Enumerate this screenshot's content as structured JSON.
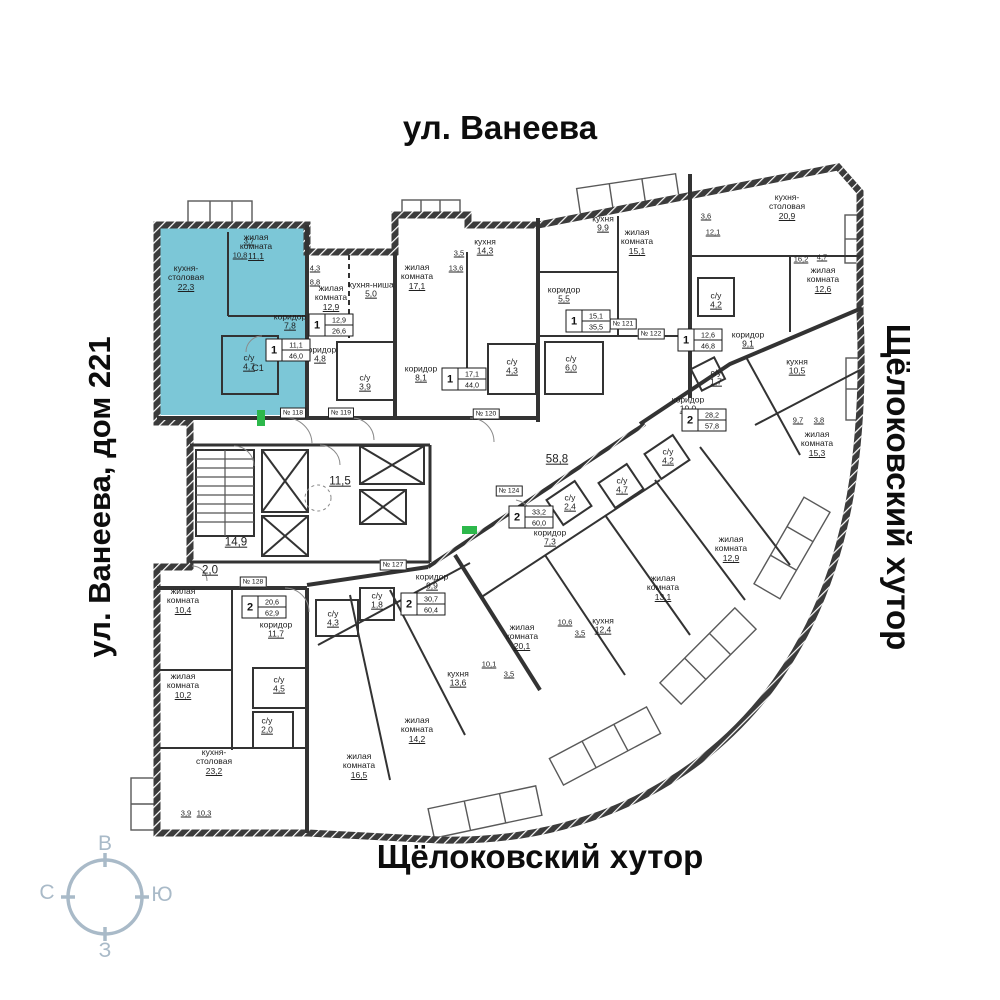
{
  "streets": {
    "top": "ул. Ванеева",
    "left": "ул. Ванеева, дом 221",
    "right": "Щёлоковский хутор",
    "bottom": "Щёлоковский хутор"
  },
  "compass": {
    "top": "В",
    "right": "Ю",
    "bottom": "З",
    "left": "С"
  },
  "colors": {
    "highlight": "#7cc7d7",
    "compass": "#a9bac8",
    "exit_green": "#2db84b",
    "wall": "#333333"
  },
  "selected_apartment": {
    "unit_id": "С1",
    "rooms": "1",
    "living_area": "11,1",
    "total_area": "46,0"
  },
  "unit_label": {
    "text": "С1",
    "x": 258,
    "y": 368
  },
  "apartment_badges": [
    {
      "rooms": "1",
      "living_area": "11,1",
      "total_area": "46,0",
      "x": 288,
      "y": 350,
      "selected": true
    },
    {
      "rooms": "1",
      "living_area": "12,9",
      "total_area": "26,6",
      "x": 331,
      "y": 325
    },
    {
      "rooms": "1",
      "living_area": "17,1",
      "total_area": "44,0",
      "x": 464,
      "y": 379
    },
    {
      "rooms": "1",
      "living_area": "15,1",
      "total_area": "35,5",
      "x": 588,
      "y": 321
    },
    {
      "rooms": "1",
      "living_area": "12,6",
      "total_area": "46,8",
      "x": 700,
      "y": 340
    },
    {
      "rooms": "2",
      "living_area": "28,2",
      "total_area": "57,8",
      "x": 704,
      "y": 420
    },
    {
      "rooms": "2",
      "living_area": "33,2",
      "total_area": "60,0",
      "x": 531,
      "y": 517
    },
    {
      "rooms": "2",
      "living_area": "30,7",
      "total_area": "60,4",
      "x": 423,
      "y": 604
    },
    {
      "rooms": "2",
      "living_area": "20,6",
      "total_area": "62,9",
      "x": 264,
      "y": 607
    }
  ],
  "room_labels": [
    {
      "name": "кухня-\nстоловая",
      "area": "22,3",
      "x": 186,
      "y": 278
    },
    {
      "name": "жилая\nкомната",
      "area": "11,1",
      "x": 256,
      "y": 247
    },
    {
      "name": "коридор",
      "area": "7,8",
      "x": 290,
      "y": 322
    },
    {
      "name": "с/у",
      "area": "4,7",
      "x": 249,
      "y": 363
    },
    {
      "name": "жилая\nкомната",
      "area": "12,9",
      "x": 331,
      "y": 298
    },
    {
      "name": "кухня-ниша",
      "area": "5,0",
      "x": 371,
      "y": 290
    },
    {
      "name": "коридор",
      "area": "4,8",
      "x": 320,
      "y": 355
    },
    {
      "name": "с/у",
      "area": "3,9",
      "x": 365,
      "y": 383
    },
    {
      "name": "жилая\nкомната",
      "area": "17,1",
      "x": 417,
      "y": 277
    },
    {
      "name": "кухня",
      "area": "14,3",
      "x": 485,
      "y": 247
    },
    {
      "name": "коридор",
      "area": "8,1",
      "x": 421,
      "y": 374
    },
    {
      "name": "с/у",
      "area": "4,3",
      "x": 512,
      "y": 367
    },
    {
      "name": "кухня",
      "area": "9,9",
      "x": 603,
      "y": 224
    },
    {
      "name": "жилая\nкомната",
      "area": "15,1",
      "x": 637,
      "y": 242
    },
    {
      "name": "коридор",
      "area": "5,5",
      "x": 564,
      "y": 295
    },
    {
      "name": "с/у",
      "area": "6,0",
      "x": 571,
      "y": 364
    },
    {
      "name": "кухня-\nстоловая",
      "area": "20,9",
      "x": 787,
      "y": 207
    },
    {
      "name": "жилая\nкомната",
      "area": "12,6",
      "x": 823,
      "y": 280
    },
    {
      "name": "с/у",
      "area": "4,2",
      "x": 716,
      "y": 301
    },
    {
      "name": "коридор",
      "area": "9,1",
      "x": 748,
      "y": 340
    },
    {
      "name": "коридор",
      "area": "10,0",
      "x": 688,
      "y": 405
    },
    {
      "name": "с/у",
      "area": "1,7",
      "x": 716,
      "y": 378
    },
    {
      "name": "кухня",
      "area": "10,5",
      "x": 797,
      "y": 367
    },
    {
      "name": "жилая\nкомната",
      "area": "15,3",
      "x": 817,
      "y": 444
    },
    {
      "name": "",
      "area": "14,9",
      "x": 236,
      "y": 543,
      "big": true
    },
    {
      "name": "",
      "area": "11,5",
      "x": 340,
      "y": 482,
      "big": true
    },
    {
      "name": "",
      "area": "2,0",
      "x": 210,
      "y": 571,
      "big": true
    },
    {
      "name": "",
      "area": "58,8",
      "x": 557,
      "y": 460,
      "big": true
    },
    {
      "name": "с/у",
      "area": "2,4",
      "x": 570,
      "y": 503
    },
    {
      "name": "с/у",
      "area": "4,7",
      "x": 622,
      "y": 486
    },
    {
      "name": "с/у",
      "area": "4,2",
      "x": 668,
      "y": 457
    },
    {
      "name": "коридор",
      "area": "7,3",
      "x": 550,
      "y": 538
    },
    {
      "name": "жилая\nкомната",
      "area": "13,1",
      "x": 663,
      "y": 588
    },
    {
      "name": "жилая\nкомната",
      "area": "12,9",
      "x": 731,
      "y": 549
    },
    {
      "name": "кухня",
      "area": "12,4",
      "x": 603,
      "y": 626
    },
    {
      "name": "жилая\nкомната",
      "area": "20,1",
      "x": 522,
      "y": 637
    },
    {
      "name": "коридор",
      "area": "9,9",
      "x": 432,
      "y": 582
    },
    {
      "name": "с/у",
      "area": "1,8",
      "x": 377,
      "y": 601
    },
    {
      "name": "с/у",
      "area": "4,3",
      "x": 333,
      "y": 619
    },
    {
      "name": "кухня",
      "area": "13,6",
      "x": 458,
      "y": 679
    },
    {
      "name": "жилая\nкомната",
      "area": "14,2",
      "x": 417,
      "y": 730
    },
    {
      "name": "жилая\nкомната",
      "area": "16,5",
      "x": 359,
      "y": 766
    },
    {
      "name": "жилая\nкомната",
      "area": "10,4",
      "x": 183,
      "y": 601
    },
    {
      "name": "жилая\nкомната",
      "area": "10,2",
      "x": 183,
      "y": 686
    },
    {
      "name": "коридор",
      "area": "11,7",
      "x": 276,
      "y": 630
    },
    {
      "name": "с/у",
      "area": "4,5",
      "x": 279,
      "y": 685
    },
    {
      "name": "с/у",
      "area": "2,0",
      "x": 267,
      "y": 726
    },
    {
      "name": "кухня-\nстоловая",
      "area": "23,2",
      "x": 214,
      "y": 762
    }
  ],
  "door_tags": [
    {
      "label": "№ 118",
      "x": 293,
      "y": 413
    },
    {
      "label": "№ 119",
      "x": 341,
      "y": 413
    },
    {
      "label": "№ 120",
      "x": 486,
      "y": 414
    },
    {
      "label": "№ 121",
      "x": 623,
      "y": 324
    },
    {
      "label": "№ 122",
      "x": 651,
      "y": 334
    },
    {
      "label": "№ 124",
      "x": 509,
      "y": 491
    },
    {
      "label": "№ 127",
      "x": 393,
      "y": 565
    },
    {
      "label": "№ 128",
      "x": 253,
      "y": 582
    }
  ],
  "dimension_labels": [
    {
      "text": "3,7",
      "x": 249,
      "y": 241
    },
    {
      "text": "10,8",
      "x": 240,
      "y": 255
    },
    {
      "text": "4,3",
      "x": 315,
      "y": 268
    },
    {
      "text": "8,8",
      "x": 315,
      "y": 282
    },
    {
      "text": "3,5",
      "x": 459,
      "y": 253
    },
    {
      "text": "13,6",
      "x": 456,
      "y": 268
    },
    {
      "text": "3,6",
      "x": 706,
      "y": 216
    },
    {
      "text": "12,1",
      "x": 713,
      "y": 232
    },
    {
      "text": "16,2",
      "x": 801,
      "y": 259
    },
    {
      "text": "4,7",
      "x": 822,
      "y": 257
    },
    {
      "text": "9,7",
      "x": 798,
      "y": 420
    },
    {
      "text": "3,8",
      "x": 819,
      "y": 420
    },
    {
      "text": "10,1",
      "x": 489,
      "y": 664
    },
    {
      "text": "3,5",
      "x": 509,
      "y": 674
    },
    {
      "text": "10,6",
      "x": 565,
      "y": 622
    },
    {
      "text": "3,5",
      "x": 580,
      "y": 633
    },
    {
      "text": "3,9",
      "x": 186,
      "y": 813
    },
    {
      "text": "10,3",
      "x": 204,
      "y": 813
    }
  ]
}
